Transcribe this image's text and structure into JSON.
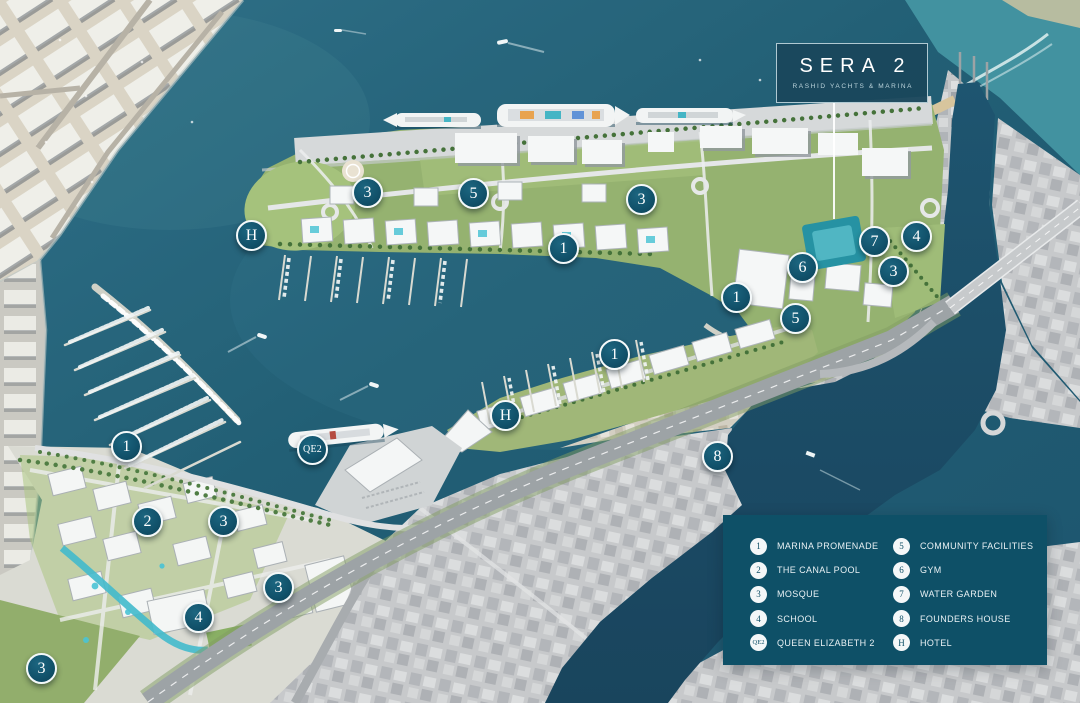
{
  "logo": {
    "title": "SERA 2",
    "subtitle": "RASHID YACHTS & MARINA"
  },
  "legend": {
    "columns": [
      {
        "items": [
          {
            "id": "1",
            "label": "MARINA PROMENADE"
          },
          {
            "id": "2",
            "label": "THE CANAL POOL"
          },
          {
            "id": "3",
            "label": "MOSQUE"
          },
          {
            "id": "4",
            "label": "SCHOOL"
          },
          {
            "id": "QE2",
            "label": "QUEEN ELIZABETH 2"
          }
        ]
      },
      {
        "items": [
          {
            "id": "5",
            "label": "COMMUNITY FACILITIES"
          },
          {
            "id": "6",
            "label": "GYM"
          },
          {
            "id": "7",
            "label": "WATER GARDEN"
          },
          {
            "id": "8",
            "label": "FOUNDERS HOUSE"
          },
          {
            "id": "H",
            "label": "HOTEL"
          }
        ]
      }
    ]
  },
  "markers": [
    {
      "id": "3",
      "x": 368,
      "y": 193
    },
    {
      "id": "5",
      "x": 474,
      "y": 194
    },
    {
      "id": "H",
      "x": 252,
      "y": 236
    },
    {
      "id": "1",
      "x": 564,
      "y": 249
    },
    {
      "id": "3",
      "x": 642,
      "y": 200
    },
    {
      "id": "7",
      "x": 875,
      "y": 242
    },
    {
      "id": "4",
      "x": 917,
      "y": 237
    },
    {
      "id": "6",
      "x": 803,
      "y": 268
    },
    {
      "id": "3",
      "x": 894,
      "y": 272
    },
    {
      "id": "1",
      "x": 737,
      "y": 298
    },
    {
      "id": "5",
      "x": 796,
      "y": 319
    },
    {
      "id": "1",
      "x": 615,
      "y": 355
    },
    {
      "id": "H",
      "x": 506,
      "y": 416
    },
    {
      "id": "QE2",
      "x": 313,
      "y": 450
    },
    {
      "id": "1",
      "x": 127,
      "y": 447
    },
    {
      "id": "8",
      "x": 718,
      "y": 457
    },
    {
      "id": "2",
      "x": 148,
      "y": 522
    },
    {
      "id": "3",
      "x": 224,
      "y": 522
    },
    {
      "id": "3",
      "x": 279,
      "y": 588
    },
    {
      "id": "4",
      "x": 199,
      "y": 618
    },
    {
      "id": "3",
      "x": 42,
      "y": 669
    }
  ],
  "colors": {
    "marker": "#11516a",
    "legend_bg": "#0e5067",
    "logo_bg": "#1a475c",
    "water": "#1a586e"
  }
}
